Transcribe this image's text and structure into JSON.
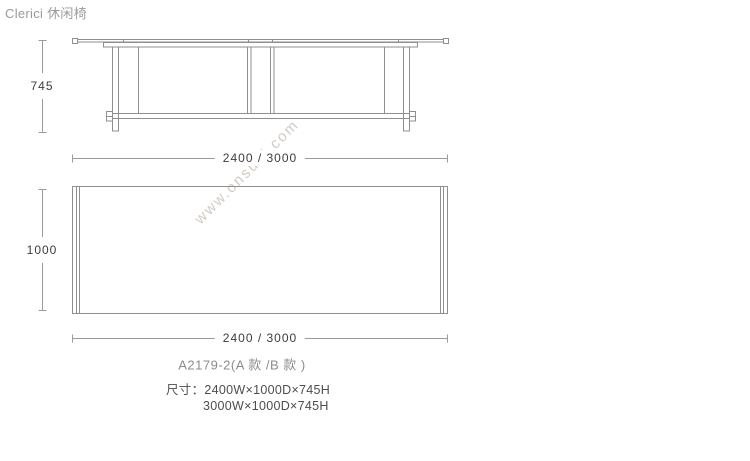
{
  "page": {
    "title": "Clerici 休闲椅"
  },
  "watermark": {
    "text": "www.onsuni.com"
  },
  "colors": {
    "drawing_line": "#8f8f8f",
    "dimension_line": "#9b9b9b",
    "dimension_text": "#3c3c3c",
    "title_text": "#9b9b9b",
    "model_text": "#8c8c8c",
    "size_text": "#4d4d4d",
    "watermark_text": "#ac9f91"
  },
  "dimensions": {
    "front_height": "745",
    "front_width": "2400 / 3000",
    "plan_depth": "1000",
    "plan_width": "2400 / 3000"
  },
  "caption": {
    "model": "A2179-2(A 款 /B 款 )",
    "size_line1": "尺寸：2400W×1000D×745H",
    "size_line2": "3000W×1000D×745H"
  }
}
